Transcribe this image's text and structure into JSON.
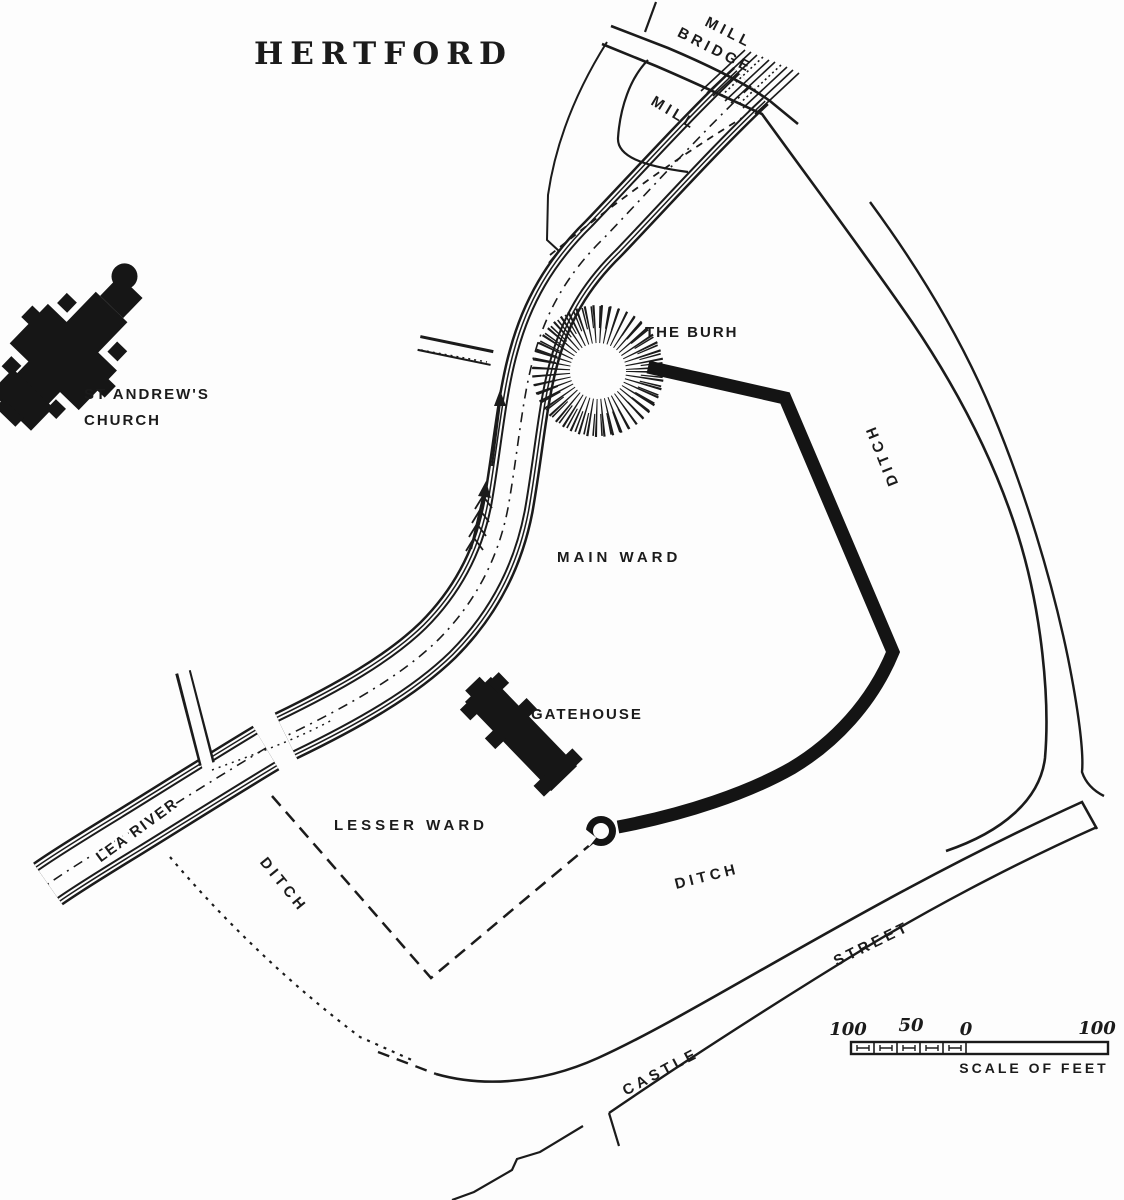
{
  "map": {
    "title": "HERTFORD",
    "labels": {
      "mill_bridge_line1": "MILL",
      "mill_bridge_line2": "BRIDGE",
      "mill": "MILL",
      "burh": "THE BURH",
      "church_line1": "ST ANDREW'S",
      "church_line2": "CHURCH",
      "main_ward": "MAIN WARD",
      "gatehouse": "GATEHOUSE",
      "lesser_ward": "LESSER WARD",
      "ditch_west": "DITCH",
      "ditch_south": "DITCH",
      "ditch_east": "DITCH",
      "lea_river": "LEA RIVER",
      "castle": "CASTLE",
      "street": "STREET"
    },
    "scale": {
      "left_100": "100",
      "mid_50": "50",
      "zero": "0",
      "right_100": "100",
      "caption": "SCALE OF FEET"
    },
    "colors": {
      "ink": "#1b1b1b",
      "paper": "#fdfdfd"
    }
  }
}
